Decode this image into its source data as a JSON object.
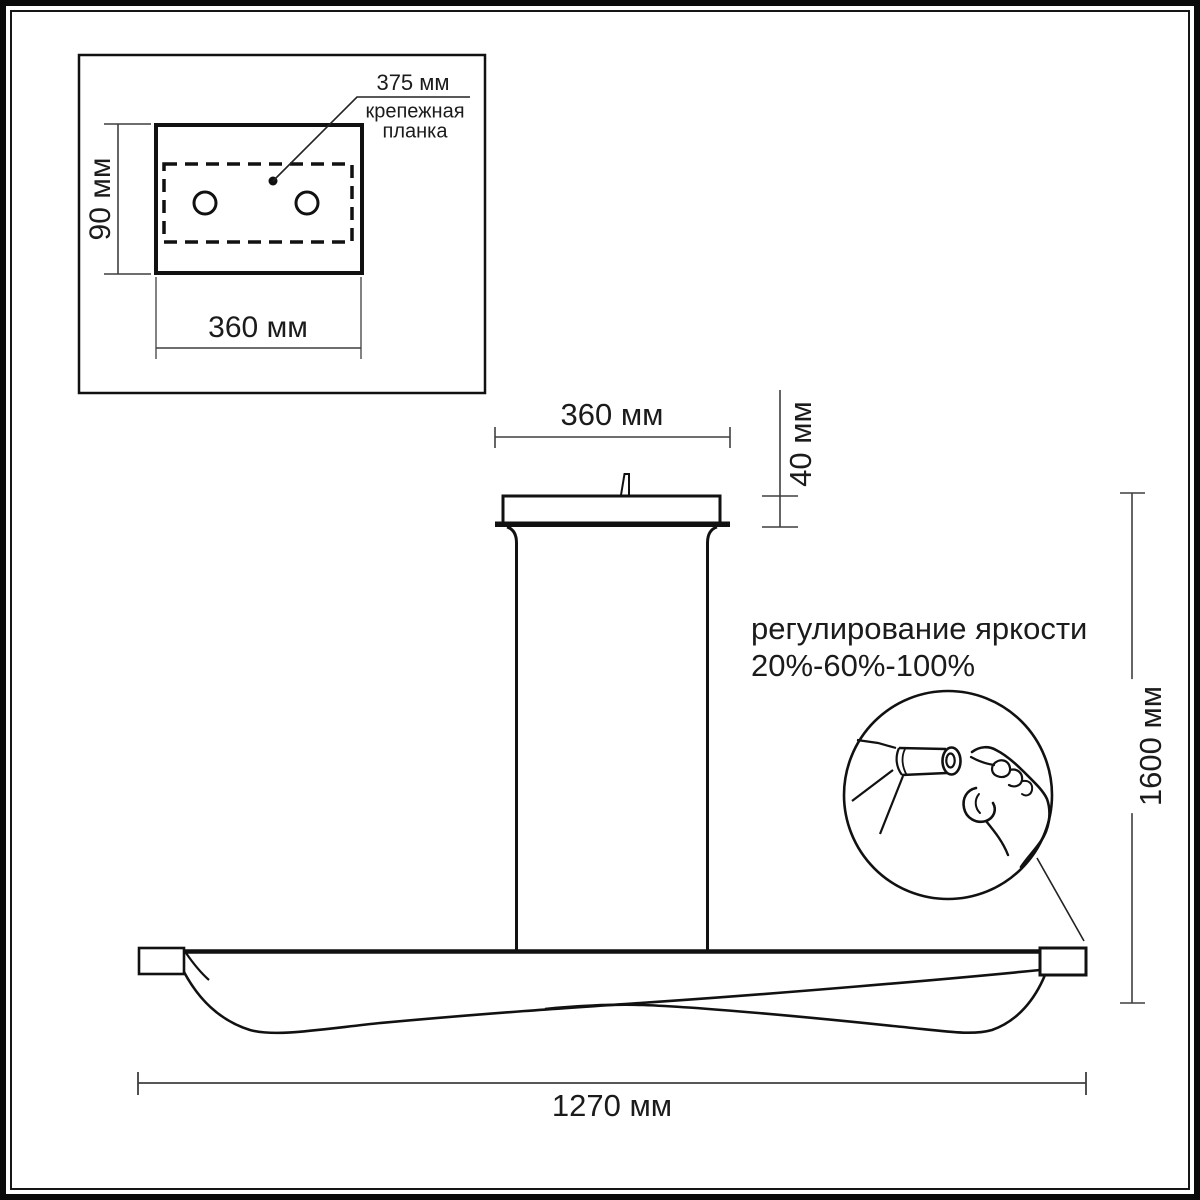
{
  "title": "Светильник подвесной — габаритный чертёж",
  "colors": {
    "line": "#111111",
    "dim_line": "#3f3f3f",
    "text": "#1b1b1b",
    "background": "#ffffff"
  },
  "inset": {
    "bracket_length_label": "375 мм",
    "bracket_name_line1": "крепежная",
    "bracket_name_line2": "планка",
    "plate_height_label": "90 мм",
    "plate_width_label": "360 мм"
  },
  "fixture": {
    "canopy_width_label": "360 мм",
    "canopy_height_label": "40 мм",
    "overall_height_label": "1600 мм",
    "bar_length_label": "1270 мм",
    "dimming_title": "регулирование яркости",
    "dimming_levels": "20%-60%-100%"
  }
}
